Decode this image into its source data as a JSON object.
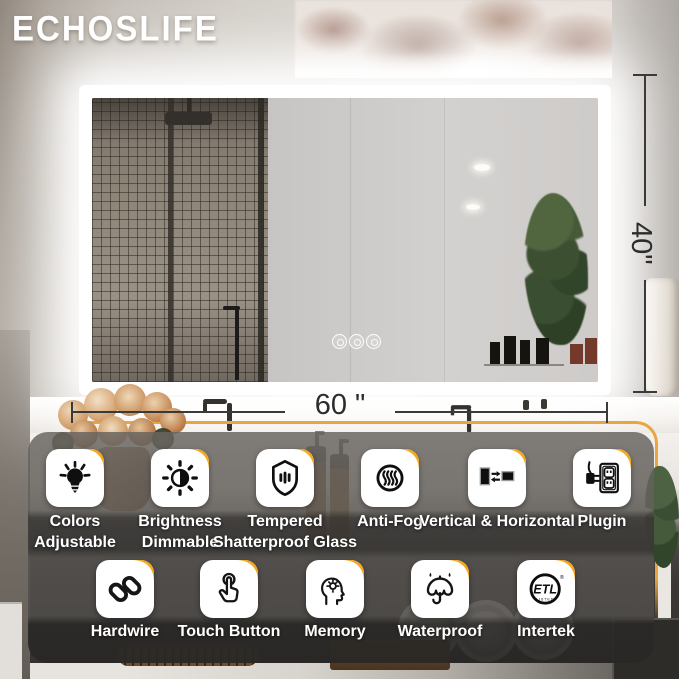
{
  "brand": {
    "logo_text": "ECHOSLIFE"
  },
  "annotations": {
    "mirror_height": "40\"",
    "mirror_width": "60 \""
  },
  "features": {
    "row1": [
      {
        "line1": "Colors",
        "line2": "Adjustable",
        "icon": "bulb-icon"
      },
      {
        "line1": "Brightness",
        "line2": "Dimmable",
        "icon": "brightness-icon"
      },
      {
        "line1": "Tempered",
        "line2": "Shatterproof Glass",
        "icon": "tempered-glass-shield-icon"
      },
      {
        "line1": "Anti-Fog",
        "line2": "",
        "icon": "anti-fog-steam-icon"
      },
      {
        "line1": "Vertical & Horizontal",
        "line2": "",
        "icon": "orientation-icon"
      },
      {
        "line1": "Plugin",
        "line2": "",
        "icon": "plug-outlet-icon"
      }
    ],
    "row2": [
      {
        "line1": "Hardwire",
        "line2": "",
        "icon": "chain-link-icon"
      },
      {
        "line1": "Touch Button",
        "line2": "",
        "icon": "touch-finger-icon"
      },
      {
        "line1": "Memory",
        "line2": "",
        "icon": "memory-head-icon"
      },
      {
        "line1": "Waterproof",
        "line2": "",
        "icon": "umbrella-icon"
      },
      {
        "line1": "Intertek",
        "line2": "",
        "icon": "etl-listed-icon"
      }
    ]
  },
  "etl_badge": {
    "main": "ETL",
    "sub": "LISTED",
    "registered": "®"
  },
  "colors": {
    "accent_gold": "#E9A63E",
    "tile_corner_orange": "#F5A81C",
    "label_text": "#FFFFFF"
  }
}
